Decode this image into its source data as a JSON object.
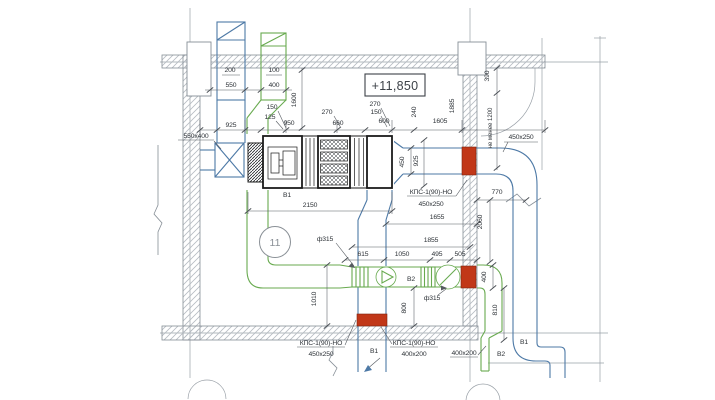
{
  "colors": {
    "b1": "#4d79a6",
    "b2": "#68aa4f",
    "damper": "#c13718",
    "struct": "#99a0a7"
  },
  "annotations": {
    "elevation": "+11,850",
    "badge": "11",
    "min_note": "не менее 1200"
  },
  "systems": {
    "b1": "В1",
    "b2": "В2"
  },
  "dampers": {
    "model": "КПС-1(90)-НО",
    "size_450": "450x250",
    "size_400": "400x200"
  },
  "sizes": {
    "s550x400": "550x400",
    "s450x250": "450x250",
    "s400x200": "400x200",
    "dia315": "ф315"
  },
  "dims": {
    "d100": "100",
    "d125": "125",
    "d150": "150",
    "d200": "200",
    "d240": "240",
    "d270": "270",
    "d390": "390",
    "d400": "400",
    "d450": "450",
    "d495": "495",
    "d505": "505",
    "d550": "550",
    "d600": "600",
    "d615": "615",
    "d660": "660",
    "d770": "770",
    "d800": "800",
    "d810": "810",
    "d925": "925",
    "d950": "950",
    "d1010": "1010",
    "d1050": "1050",
    "d1600": "1600",
    "d1605": "1605",
    "d1655": "1655",
    "d1855": "1855",
    "d1885": "1885",
    "d2060": "2060",
    "d2150": "2150"
  }
}
